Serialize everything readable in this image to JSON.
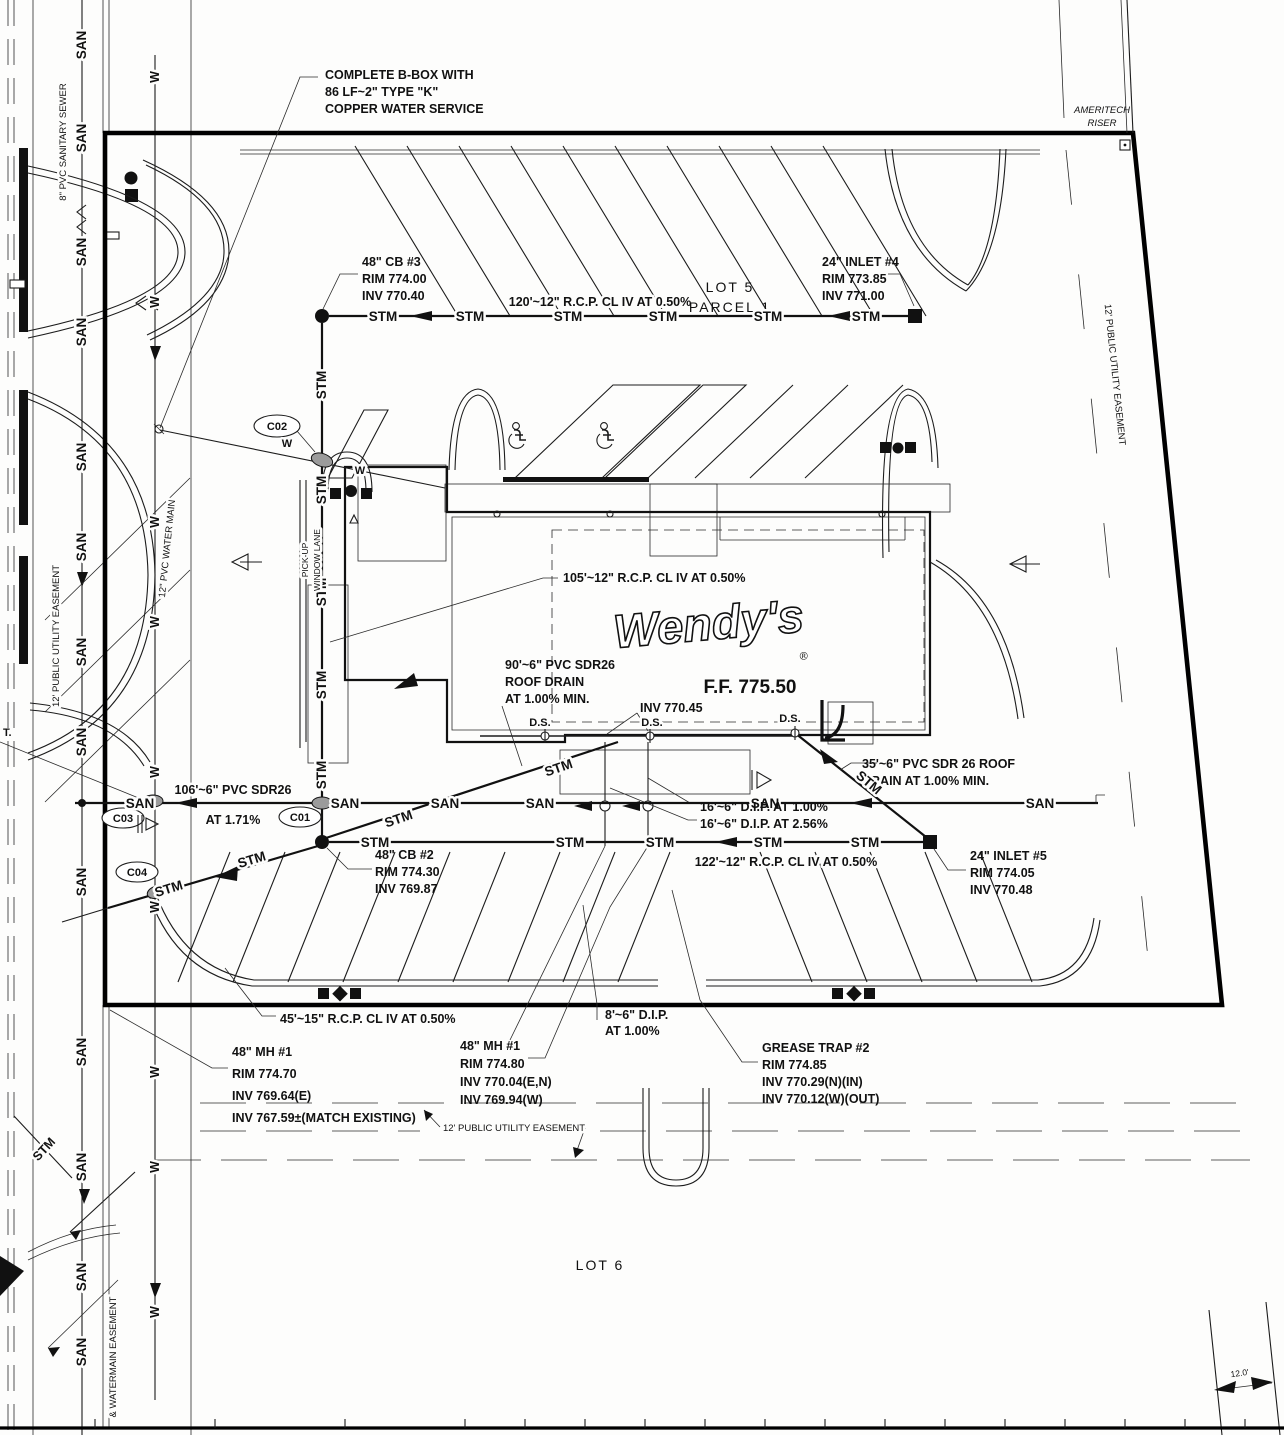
{
  "plan": {
    "logo": "Wendy's",
    "registered": "®",
    "ff": "F.F. 775.50",
    "lot5": "LOT 5",
    "parcel1": "PARCEL 1",
    "lot6": "LOT 6",
    "ameritech1": "AMERITECH",
    "ameritech2": "RISER",
    "pickup1": "PICK-UP",
    "pickup2": "WINDOW LANE",
    "dim12": "12.0'",
    "t_abbr": "T."
  },
  "line_labels": {
    "san": "SAN",
    "stm": "STM",
    "w": "W",
    "ds": "D.S."
  },
  "cleanouts": {
    "c01": "C01",
    "c02": "C02",
    "c03": "C03",
    "c04": "C04"
  },
  "easements": {
    "pue": "12' PUBLIC UTILITY EASEMENT",
    "sanitary8": "8\" PVC SANITARY SEWER",
    "watermain12": "12\" PVC WATER MAIN",
    "watermain_easement": "& WATERMAIN EASEMENT"
  },
  "callouts": {
    "bbox": [
      "COMPLETE B-BOX WITH",
      "86 LF~2\" TYPE \"K\"",
      "COPPER WATER SERVICE"
    ],
    "cb3": [
      "48\" CB #3",
      "RIM 774.00",
      "INV 770.40"
    ],
    "inlet4": [
      "24\" INLET #4",
      "RIM 773.85",
      "INV 771.00"
    ],
    "rcp120": "120'~12\" R.C.P. CL IV AT 0.50%",
    "rcp105": "105'~12\" R.C.P. CL IV AT 0.50%",
    "roof90": [
      "90'~6\" PVC SDR26",
      "ROOF DRAIN",
      "AT 1.00% MIN."
    ],
    "inv_roof": "INV 770.45",
    "roof35": [
      "35'~6\" PVC SDR 26 ROOF",
      "DRAIN AT 1.00% MIN."
    ],
    "san106": [
      "106'~6\" PVC SDR26",
      "AT 1.71%"
    ],
    "dip16_1": "16'~6\" D.I.P. AT 1.00%",
    "dip16_2": "16'~6\" D.I.P. AT 2.56%",
    "cb2": [
      "48\" CB #2",
      "RIM 774.30",
      "INV 769.87"
    ],
    "rcp122": "122'~12\" R.C.P. CL IV AT 0.50%",
    "inlet5": [
      "24\" INLET #5",
      "RIM 774.05",
      "INV 770.48"
    ],
    "rcp45": "45'~15\" R.C.P. CL IV AT 0.50%",
    "mh1_west": [
      "48\" MH #1",
      "RIM 774.70",
      "INV 769.64(E)",
      "INV 767.59±(MATCH EXISTING)"
    ],
    "mh1_east": [
      "48\" MH #1",
      "RIM 774.80",
      "INV 770.04(E,N)",
      "INV 769.94(W)"
    ],
    "dip8": [
      "8'~6\" D.I.P.",
      "AT 1.00%"
    ],
    "grease2": [
      "GREASE TRAP #2",
      "RIM 774.85",
      "INV 770.29(N)(IN)",
      "INV 770.12(W)(OUT)"
    ]
  }
}
